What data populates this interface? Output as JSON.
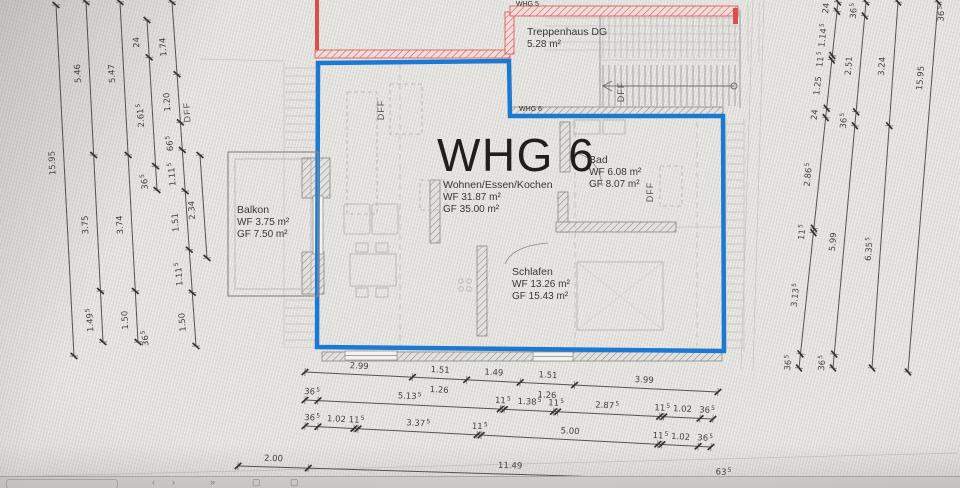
{
  "plan": {
    "unit_title": "WHG 6",
    "small_labels": {
      "whg5": "WHG 5",
      "whg6": "WHG 6"
    },
    "rooms": [
      {
        "id": "treppenhaus",
        "name": "Treppenhaus DG",
        "line1": "5.28 m²",
        "line2": ""
      },
      {
        "id": "wohnen",
        "name": "Wohnen/Essen/Kochen",
        "line1": "WF 31.87 m²",
        "line2": "GF 35.00 m²"
      },
      {
        "id": "bad",
        "name": "Bad",
        "line1": "WF 6.08 m²",
        "line2": "GF 8.07 m²"
      },
      {
        "id": "balkon",
        "name": "Balkon",
        "line1": "WF 3.75 m²",
        "line2": "GF 7.50 m²"
      },
      {
        "id": "schlafen",
        "name": "Schlafen",
        "line1": "WF 13.26 m²",
        "line2": "GF 15.43 m²"
      }
    ],
    "colors": {
      "unit_outline": "#1b79d4",
      "neighbor_outline": "#d8504e",
      "dimension_text": "#45433f"
    }
  },
  "dimensions": {
    "chains": [
      {
        "id": "L1",
        "x1": 56,
        "y1": 5,
        "x2": 74,
        "y2": 356,
        "side": 1,
        "ticks": [
          0,
          1
        ],
        "labels": [
          {
            "t": "15.95",
            "f": 0.44
          }
        ]
      },
      {
        "id": "L2",
        "x1": 86,
        "y1": 2,
        "x2": 103,
        "y2": 342,
        "side": 1,
        "ticks": [
          0,
          0.45,
          0.85,
          1
        ],
        "labels": [
          {
            "t": "5.46",
            "f": 0.2
          },
          {
            "t": "3.75",
            "f": 0.645
          },
          {
            "t": "1.49",
            "sup": "5",
            "f": 0.925
          }
        ]
      },
      {
        "id": "L3",
        "x1": 120,
        "y1": 2,
        "x2": 138,
        "y2": 342,
        "side": 1,
        "ticks": [
          0,
          0.45,
          0.85,
          1
        ],
        "labels": [
          {
            "t": "5.47",
            "f": 0.2
          },
          {
            "t": "3.74",
            "f": 0.645
          },
          {
            "t": "1.50",
            "f": 0.925
          }
        ]
      },
      {
        "id": "L4",
        "x1": 147,
        "y1": 20,
        "x2": 157,
        "y2": 190,
        "side": 1,
        "ticks": [
          0,
          0.22,
          0.86,
          1
        ],
        "labels": [
          {
            "t": "24",
            "f": 0.11
          },
          {
            "t": "2.61",
            "sup": "5",
            "f": 0.54
          },
          {
            "t": "36",
            "sup": "5",
            "f": 0.93
          }
        ]
      },
      {
        "id": "L5",
        "x1": 172,
        "y1": 2,
        "x2": 196,
        "y2": 346,
        "side": 1,
        "ticks": [
          0,
          0.21,
          0.35,
          0.43,
          0.55,
          0.72,
          0.845,
          1
        ],
        "labels": [
          {
            "t": "1.74",
            "f": 0.12
          },
          {
            "t": "1.20",
            "f": 0.28
          },
          {
            "t": "66",
            "sup": "5",
            "f": 0.4
          },
          {
            "t": "1.11",
            "sup": "5",
            "f": 0.49
          },
          {
            "t": "1.51",
            "f": 0.63
          },
          {
            "t": "1.11",
            "sup": "5",
            "f": 0.78
          },
          {
            "t": "1.50",
            "f": 0.92
          }
        ]
      },
      {
        "id": "L6",
        "x1": 200,
        "y1": 155,
        "x2": 207,
        "y2": 258,
        "side": 1,
        "ticks": [
          0,
          1
        ],
        "labels": [
          {
            "t": "2.34",
            "f": 0.5
          }
        ]
      },
      {
        "id": "R1",
        "x1": 838,
        "y1": 2,
        "x2": 799,
        "y2": 368,
        "side": 1,
        "ticks": [
          0,
          0.0253,
          0.1462,
          0.1584,
          0.2904,
          0.3157,
          0.6183,
          0.6304,
          0.9615,
          1
        ],
        "labels": [
          {
            "t": "24",
            "f": 0.012
          },
          {
            "t": "1.14",
            "sup": "5",
            "f": 0.086
          },
          {
            "t": "11",
            "sup": "5",
            "f": 0.152
          },
          {
            "t": "1.25",
            "f": 0.224
          },
          {
            "t": "24",
            "f": 0.303
          },
          {
            "t": "2.86",
            "sup": "5",
            "f": 0.467
          },
          {
            "t": "11",
            "sup": "5",
            "f": 0.624
          },
          {
            "t": "3.13",
            "sup": "5",
            "f": 0.796
          },
          {
            "t": "36",
            "sup": "5",
            "f": 0.981
          }
        ]
      },
      {
        "id": "R2",
        "x1": 866,
        "y1": 2,
        "x2": 833,
        "y2": 368,
        "side": 1,
        "ticks": [
          0,
          0.038,
          0.3,
          0.338,
          0.962,
          1
        ],
        "labels": [
          {
            "t": "36",
            "sup": "5",
            "f": 0.019
          },
          {
            "t": "2.51",
            "f": 0.169
          },
          {
            "t": "36",
            "sup": "5",
            "f": 0.319
          },
          {
            "t": "5.99",
            "f": 0.65
          },
          {
            "t": "36",
            "sup": "5",
            "f": 0.981
          }
        ]
      },
      {
        "id": "R3",
        "x1": 898,
        "y1": 2,
        "x2": 872,
        "y2": 368,
        "side": 1,
        "ticks": [
          0,
          0.338,
          1
        ],
        "labels": [
          {
            "t": "3.24",
            "f": 0.17
          },
          {
            "t": "6.35",
            "sup": "5",
            "f": 0.669
          }
        ]
      },
      {
        "id": "R4",
        "x1": 938,
        "y1": 2,
        "x2": 908,
        "y2": 372,
        "side": 1,
        "ticks": [
          0,
          1
        ],
        "labels": [
          {
            "t": "15.95",
            "f": 0.2
          }
        ]
      },
      {
        "id": "B1",
        "x1": 305,
        "y1": 372,
        "x2": 718,
        "y2": 392,
        "side": -1,
        "ticks": [
          0,
          0.26,
          0.3914,
          0.521,
          0.6527,
          1
        ],
        "labels": [
          {
            "t": "2.99",
            "f": 0.13
          },
          {
            "t": "1.51",
            "f": 0.326
          },
          {
            "t": "1.49",
            "f": 0.456
          },
          {
            "t": "1.51",
            "f": 0.587
          },
          {
            "t": "3.99",
            "f": 0.82
          },
          {
            "t": "1.26",
            "f": 0.326,
            "side": 1,
            "off": 11
          },
          {
            "t": "1.26",
            "f": 0.587,
            "side": 1,
            "off": 11
          }
        ]
      },
      {
        "id": "B2",
        "x1": 305,
        "y1": 400,
        "x2": 713,
        "y2": 419,
        "side": -1,
        "ticks": [
          0,
          0.0318,
          0.4786,
          0.4886,
          0.6091,
          0.6191,
          0.8693,
          0.8793,
          0.9682,
          1
        ],
        "labels": [
          {
            "t": "36",
            "sup": "5",
            "f": 0.016
          },
          {
            "t": "5.13",
            "sup": "5",
            "f": 0.255
          },
          {
            "t": "11",
            "sup": "5",
            "f": 0.4836
          },
          {
            "t": "1.38",
            "sup": "5",
            "f": 0.549
          },
          {
            "t": "11",
            "sup": "5",
            "f": 0.6141
          },
          {
            "t": "2.87",
            "sup": "5",
            "f": 0.7392
          },
          {
            "t": "11",
            "sup": "5",
            "f": 0.8743
          },
          {
            "t": "1.02",
            "f": 0.9238
          },
          {
            "t": "36",
            "sup": "5",
            "f": 0.9841
          }
        ]
      },
      {
        "id": "B3",
        "x1": 305,
        "y1": 426,
        "x2": 711,
        "y2": 447,
        "side": -1,
        "ticks": [
          0,
          0.0318,
          0.1206,
          0.1306,
          0.4239,
          0.4339,
          0.869,
          0.879,
          0.9682,
          1
        ],
        "labels": [
          {
            "t": "36",
            "sup": "5",
            "f": 0.016
          },
          {
            "t": "1.02",
            "f": 0.0762
          },
          {
            "t": "11",
            "sup": "5",
            "f": 0.1256
          },
          {
            "t": "3.37",
            "sup": "5",
            "f": 0.2772
          },
          {
            "t": "11",
            "sup": "5",
            "f": 0.4289
          },
          {
            "t": "5.00",
            "f": 0.6515
          },
          {
            "t": "11",
            "sup": "5",
            "f": 0.874
          },
          {
            "t": "1.02",
            "f": 0.9236
          },
          {
            "t": "36",
            "sup": "5",
            "f": 0.9841
          }
        ]
      },
      {
        "id": "B4",
        "x1": 238,
        "y1": 466,
        "x2": 734,
        "y2": 481,
        "side": -1,
        "ticks": [
          0,
          0.1416,
          0.9552,
          1
        ],
        "labels": [
          {
            "t": "2.00",
            "f": 0.071
          },
          {
            "t": "11.49",
            "f": 0.548
          },
          {
            "t": "63",
            "sup": "5",
            "f": 0.978
          }
        ]
      }
    ],
    "texts": [
      {
        "t": "DFF",
        "x": 190,
        "y": 112,
        "rot": -93,
        "cls": "dff"
      },
      {
        "t": "DFF",
        "x": 384,
        "y": 110,
        "rot": -90,
        "cls": "dff"
      },
      {
        "t": "DFF",
        "x": 653,
        "y": 192,
        "rot": -90,
        "cls": "dff"
      },
      {
        "t": "DFF",
        "x": 624,
        "y": 92,
        "rot": -90,
        "cls": "dff"
      },
      {
        "t": "36",
        "sup": "5",
        "x": 148,
        "y": 338,
        "rot": -93,
        "cls": "dtx"
      },
      {
        "t": "36",
        "sup": "5",
        "x": 944,
        "y": 14,
        "rot": -85,
        "cls": "dtx"
      }
    ]
  },
  "statusbar": {
    "icons": [
      {
        "name": "scroll-track-icon",
        "glyph": ""
      },
      {
        "name": "scroll-left-icon",
        "glyph": "‹"
      },
      {
        "name": "scroll-right-icon",
        "glyph": "›"
      },
      {
        "name": "jump-forward-icon",
        "glyph": "»"
      },
      {
        "name": "page-icon",
        "glyph": "▢"
      },
      {
        "name": "copy-page-icon",
        "glyph": "▢"
      }
    ]
  }
}
